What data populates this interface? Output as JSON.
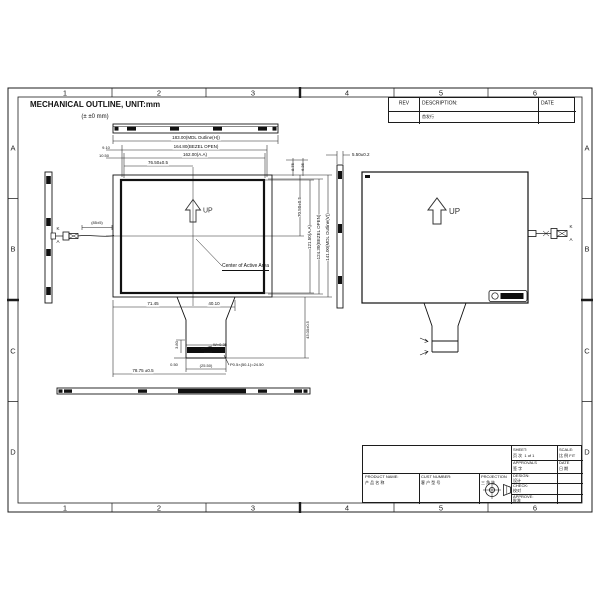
{
  "page": {
    "title": "MECHANICAL OUTLINE, UNIT:mm",
    "tolerance_note": "(± ±0 mm)"
  },
  "zones": {
    "cols": [
      "1",
      "2",
      "3",
      "4",
      "5",
      "6"
    ],
    "rows": [
      "A",
      "B",
      "C",
      "D"
    ]
  },
  "rev_table": {
    "rev_header": "REV",
    "description_header": "DESCRIPTION:",
    "date_header": "DATE",
    "entry_description": "首发行"
  },
  "front_view": {
    "up": "UP",
    "center_label": "Center of Active Area",
    "dims": {
      "mdl_h": "183.00(MDL Outline(H))",
      "bezel_h": "164.80(BEZEL OPEN)",
      "aa_h": "162.00(A.A)",
      "half_h": "76.50±0.5",
      "off_1": "9.10",
      "off_2": "10.50",
      "tr_1": "8.75",
      "tr_2": "6.35",
      "half_v": "70.50±0.5",
      "aa_v": "121.50(A.A)",
      "bezel_v": "124.30(BEZEL OPEN)",
      "mdl_v": "141.00(MDL Outline(V))"
    }
  },
  "fpc": {
    "left": "71.45",
    "width": "40.10",
    "h1": "3.80",
    "w_trace": "W=0.35",
    "p_trace": "P=0.5",
    "end": "0.50",
    "width_b": "(25.50)",
    "pitch": "P0.5×(50-1)=24.50",
    "bottom": "78.75 ±0.5",
    "length": "43.00±0.5"
  },
  "side_view": {
    "thickness": "5.50±0.2"
  },
  "backlight": {
    "wire_len": "(85±5)",
    "k": "K",
    "a": "A"
  },
  "rear_view": {
    "up": "UP",
    "k": "K",
    "a": "A"
  },
  "title_block": {
    "product_name": "PRODUCT NAME:",
    "product_name_cn": "产 品 名 称",
    "cust_number": "CUST NUMBER:",
    "cust_number_cn": "客 户 型 号",
    "projection": "PROJECTION",
    "projection_cn": "三 角 法",
    "sheet": "SHEET:",
    "sheet_cn": "页 次",
    "sheet_value": "1 of 1",
    "scale": "SCALE:",
    "scale_cn": "比 例",
    "scale_value": "FIT",
    "approvals": "APPROVALS",
    "approvals_cn": "签 字",
    "date": "DATE",
    "date_cn": "日 期",
    "design": "DESIGN:",
    "design_cn": "设计",
    "check": "CHECK:",
    "check_cn": "校对",
    "approve": "APPROVE:",
    "approve_cn": "批准"
  }
}
